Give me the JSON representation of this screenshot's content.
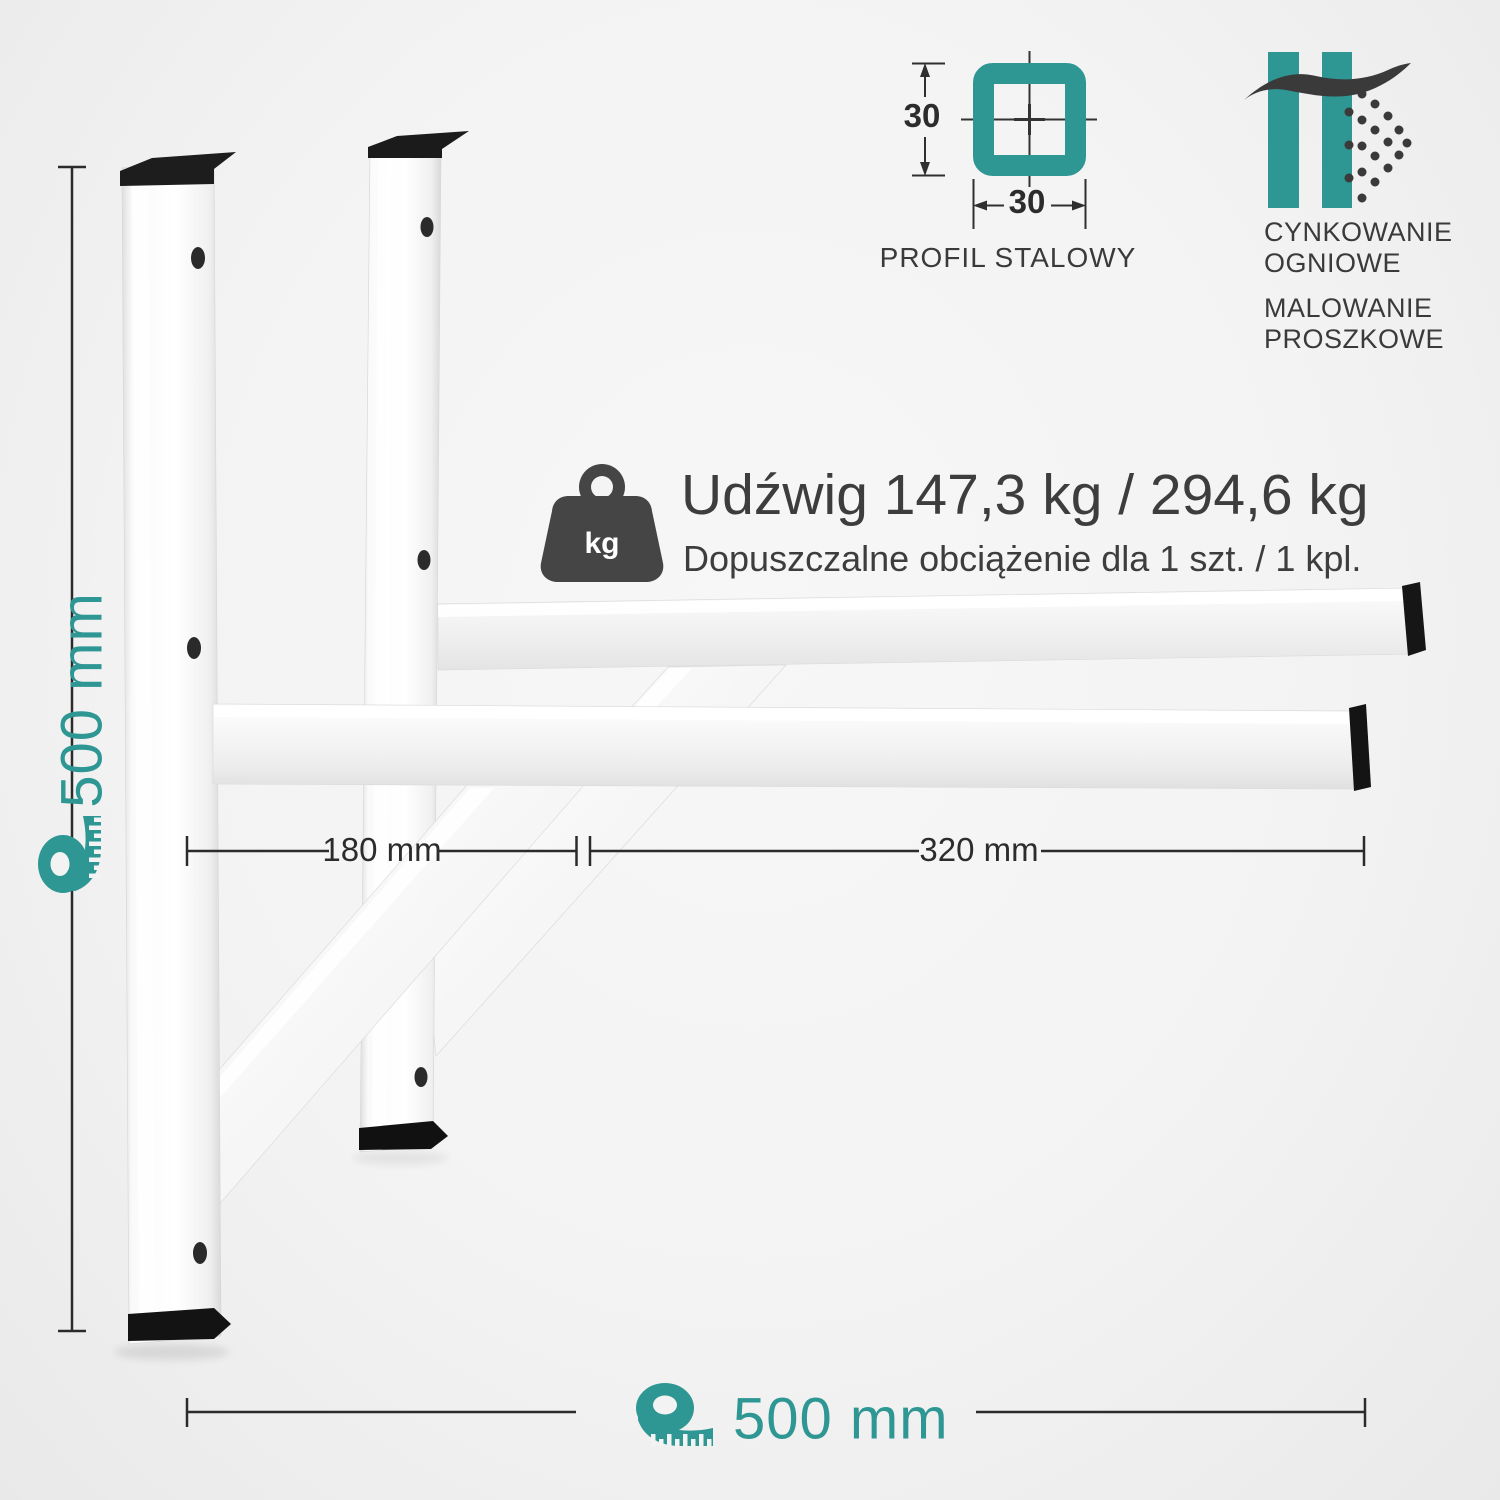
{
  "page": {
    "background": "#f3f3f3",
    "accent_teal": "#2E9693",
    "text_dark": "#3c3c3c",
    "line_color": "#2b2b2b"
  },
  "dimensions": {
    "height_label": "500 mm",
    "width_label": "500 mm",
    "wall_section_label": "180 mm",
    "overhang_label": "320 mm"
  },
  "profile": {
    "size_vertical": "30",
    "size_horizontal": "30",
    "label": "PROFIL STALOWY"
  },
  "coatings": {
    "galvanizing_line1": "CYNKOWANIE",
    "galvanizing_line2": "OGNIOWE",
    "painting_line1": "MALOWANIE",
    "painting_line2": "PROSZKOWE"
  },
  "capacity": {
    "icon_label": "kg",
    "title": "Udźwig 147,3 kg / 294,6 kg",
    "subtitle": "Dopuszczalne obciążenie dla 1 szt. / 1 kpl."
  },
  "icons": {
    "tape_measure": "tape-measure-icon",
    "steel_profile": "steel-profile-cross-section-icon",
    "galvanizing": "hot-dip-galvanizing-icon",
    "weight": "kettlebell-weight-icon"
  }
}
